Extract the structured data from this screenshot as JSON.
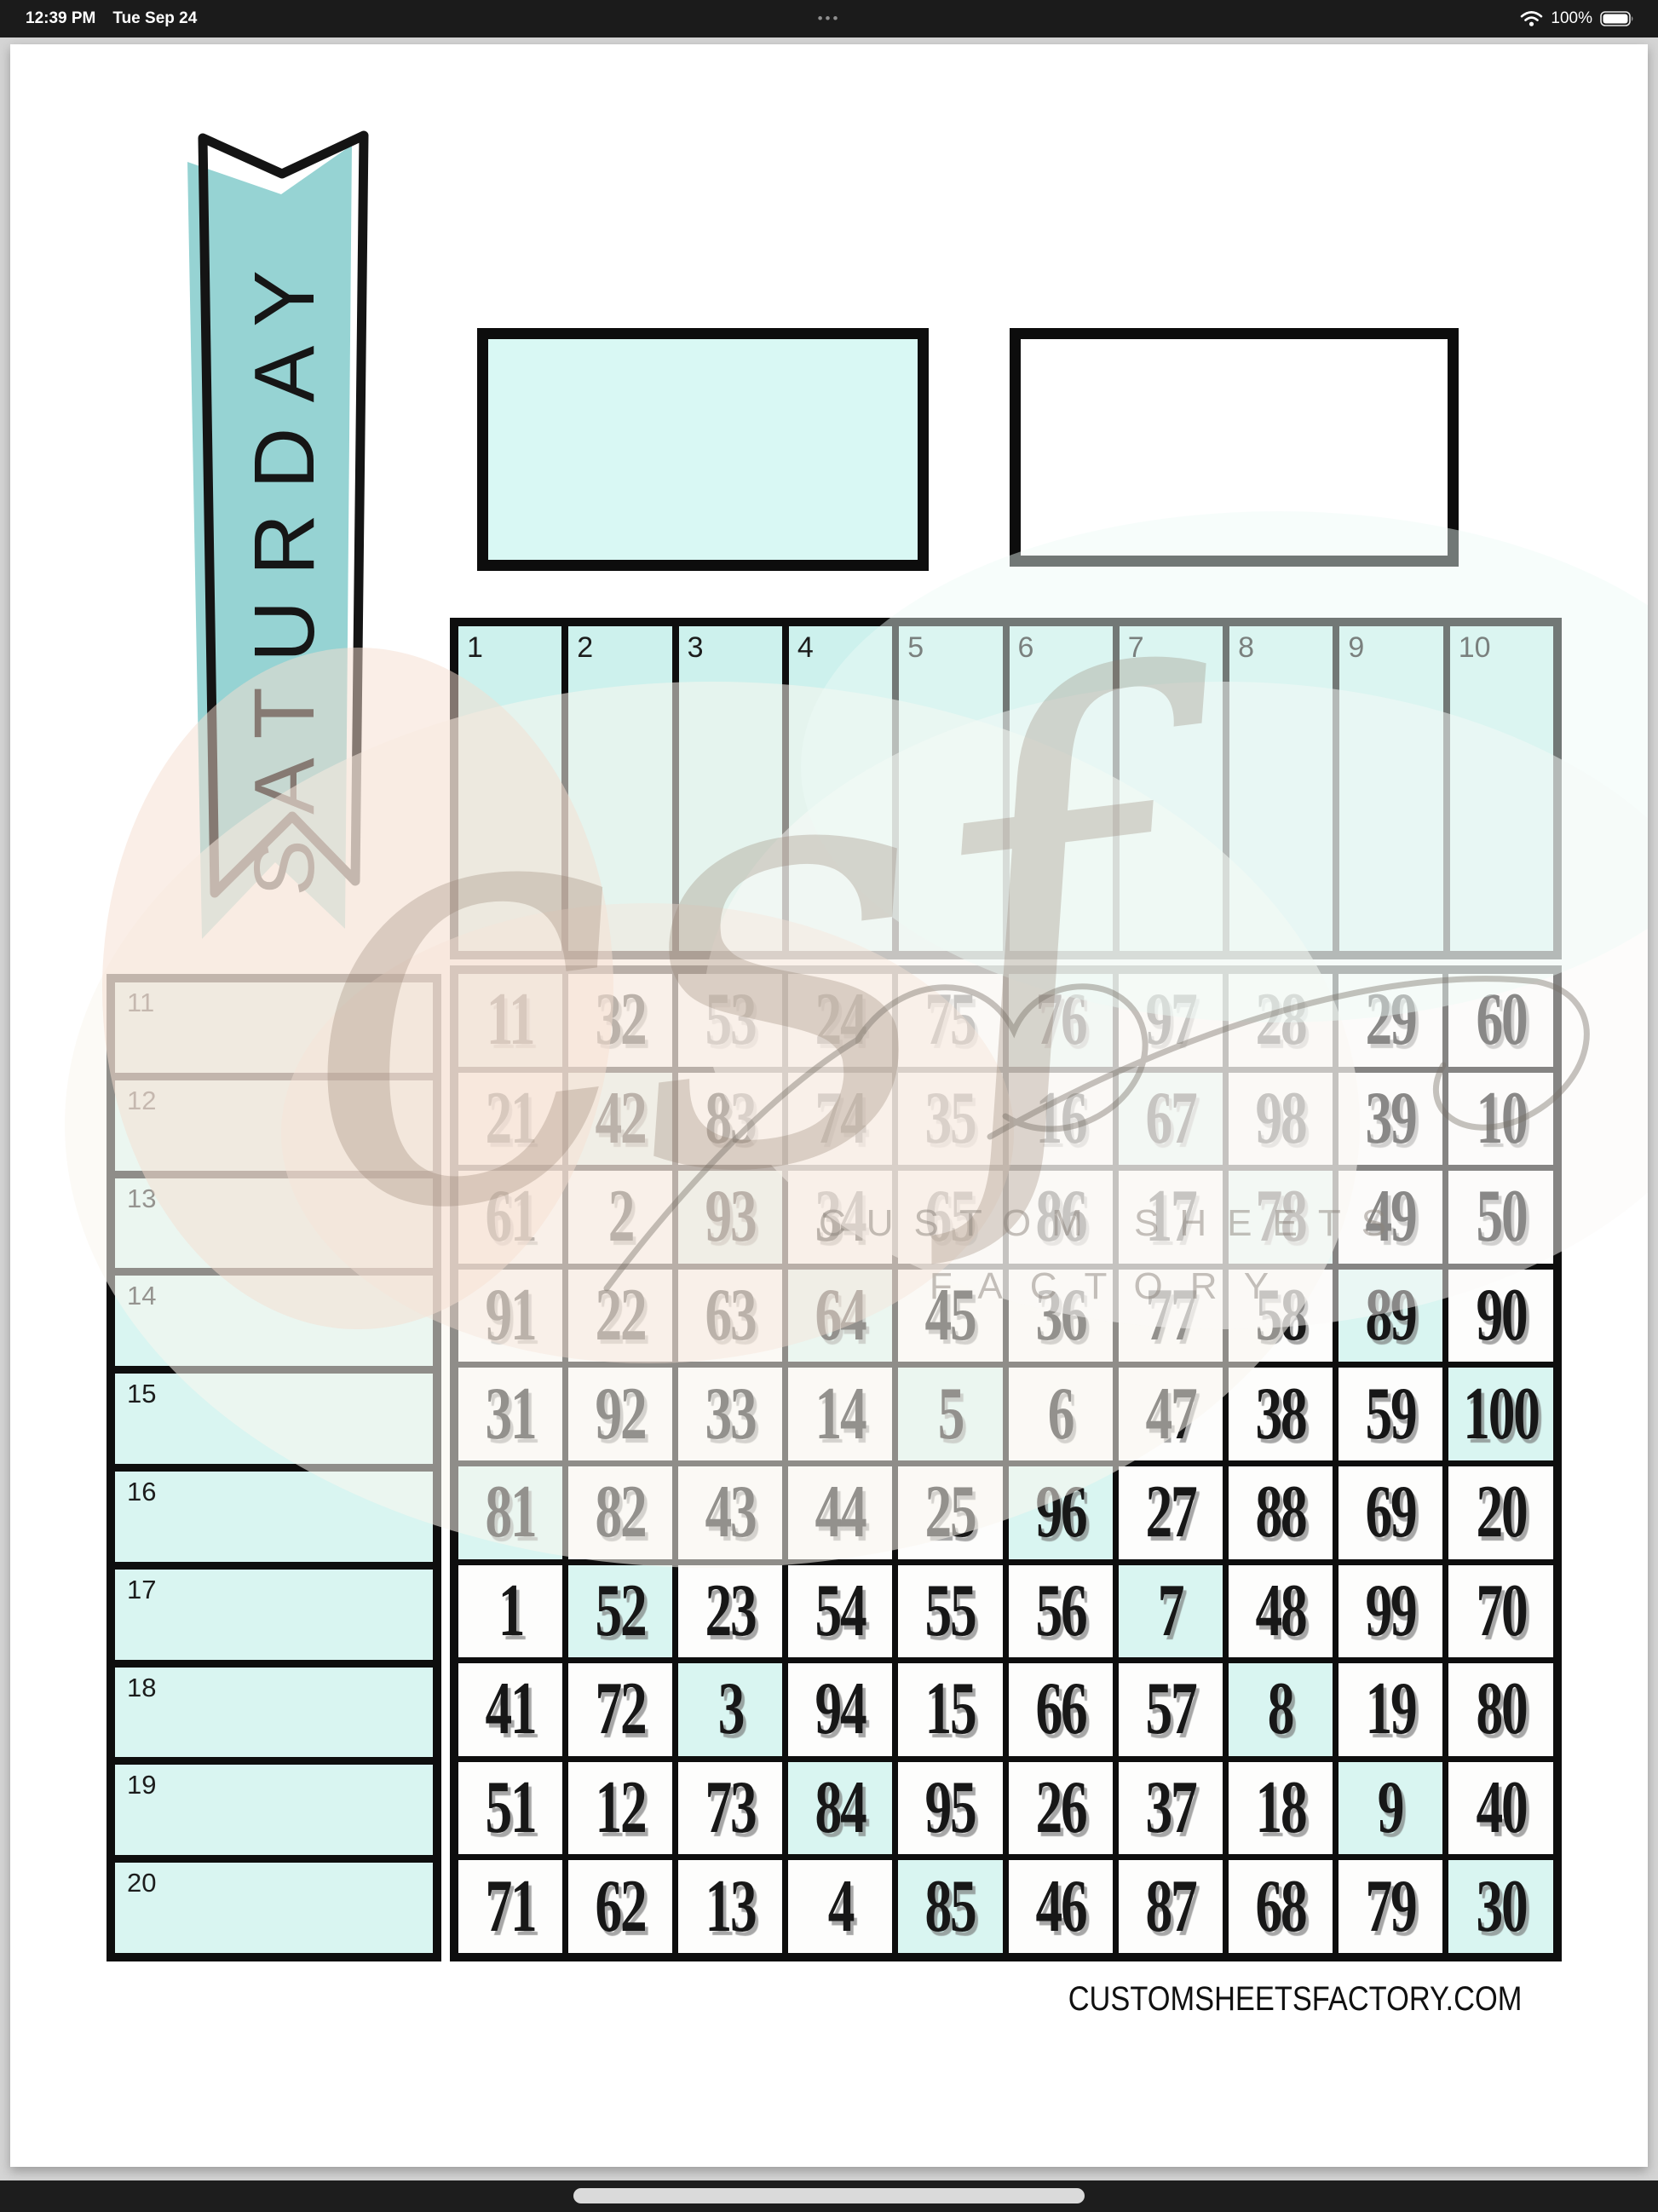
{
  "status_bar": {
    "time": "12:39 PM",
    "date": "Tue Sep 24",
    "menu_dots": "•••",
    "battery_percent": "100%"
  },
  "banner": {
    "label": "SATURDAY"
  },
  "top_columns": {
    "labels": [
      "1",
      "2",
      "3",
      "4",
      "5",
      "6",
      "7",
      "8",
      "9",
      "10"
    ]
  },
  "side_rows": {
    "labels": [
      "11",
      "12",
      "13",
      "14",
      "15",
      "16",
      "17",
      "18",
      "19",
      "20"
    ]
  },
  "number_grid": {
    "rows": [
      [
        11,
        32,
        53,
        24,
        75,
        76,
        97,
        28,
        29,
        60
      ],
      [
        21,
        42,
        83,
        74,
        35,
        16,
        67,
        98,
        39,
        10
      ],
      [
        61,
        2,
        93,
        34,
        65,
        86,
        17,
        78,
        49,
        50
      ],
      [
        91,
        22,
        63,
        64,
        45,
        36,
        77,
        58,
        89,
        90
      ],
      [
        31,
        92,
        33,
        14,
        5,
        6,
        47,
        38,
        59,
        100
      ],
      [
        81,
        82,
        43,
        44,
        25,
        96,
        27,
        88,
        69,
        20
      ],
      [
        1,
        52,
        23,
        54,
        55,
        56,
        7,
        48,
        99,
        70
      ],
      [
        41,
        72,
        3,
        94,
        15,
        66,
        57,
        8,
        19,
        80
      ],
      [
        51,
        12,
        73,
        84,
        95,
        26,
        37,
        18,
        9,
        40
      ],
      [
        71,
        62,
        13,
        4,
        85,
        46,
        87,
        68,
        79,
        30
      ]
    ],
    "highlighted_numbers": [
      11,
      76,
      42,
      67,
      93,
      78,
      64,
      89,
      5,
      100,
      81,
      96,
      52,
      7,
      3,
      8,
      84,
      9,
      85,
      30
    ]
  },
  "watermark": {
    "script": "csf",
    "line1": "CUSTOM SHEETS",
    "line2": "FACTORY"
  },
  "footer": {
    "website": "CUSTOMSHEETSFACTORY.COM"
  },
  "colors": {
    "ribbon_teal": "#96d3d3",
    "column_cell": "#cdf1ed",
    "side_cell": "#d9f5f1",
    "highlight_cell": "#d9f5f1",
    "box_mint": "#d9f8f4",
    "grid_line": "#0e0e0e",
    "chrome_bg": "#1b1b1b"
  }
}
